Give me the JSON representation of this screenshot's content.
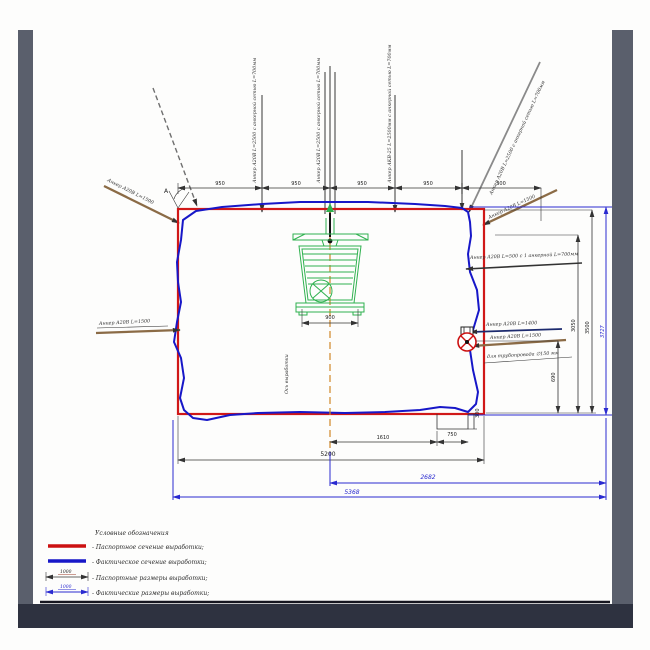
{
  "colors": {
    "design_section": "#d01818",
    "actual_section": "#1717c8",
    "machine": "#2fb14f",
    "frame_side": "#5a5f6c",
    "frame_bottom": "#2e3240"
  },
  "section": {
    "axis_label": "Ось выработки",
    "angle_mark": "А"
  },
  "anchors": {
    "top_v1": "Анкер А20В L=2500 с анкерной сетью L=700мм",
    "top_v2": "Анкер А20В L=2500 с анкерной сетью L=700мм",
    "top_v3": "Анкер АКВ-25 L=2500мм с анкерной сетью L=700мм",
    "top_right_diag": "Анкер А20В L=2500 с анкерной сетью L=700мм",
    "corner_left": "Анкер А20В L=1500",
    "corner_right": "Анкер А20В L=1500",
    "left_mid": "Анкер А20В L=1500",
    "right_wall": "Анкер А20В L=500 с 1 анкерной L=700мм",
    "right_low_1": "Анкер А20В L=1400",
    "right_low_2": "Анкер А20В L=1500",
    "pipe_note": "для трубопровода ∅150 мм"
  },
  "dims": {
    "top": [
      "950",
      "950",
      "950",
      "950",
      "300"
    ],
    "machine_900": "900",
    "bottom_1610": "1610",
    "bottom_750": "750",
    "ditch_300": "300",
    "bottom_5200": "5200",
    "bottom_2682": "2682",
    "bottom_5368": "5368",
    "right_690": "690",
    "right_3050": "3050",
    "right_3500": "3500",
    "right_3727": "3727"
  },
  "legend": {
    "title": "Условные обозначения",
    "items": [
      {
        "label": "- Паспортное сечение выработки;"
      },
      {
        "label": "- Фактическое сечение выработки;"
      },
      {
        "label": "- Паспортные размеры выработки;",
        "value": "1000"
      },
      {
        "label": "- Фактические размеры выработки;",
        "value": "1000"
      }
    ]
  }
}
